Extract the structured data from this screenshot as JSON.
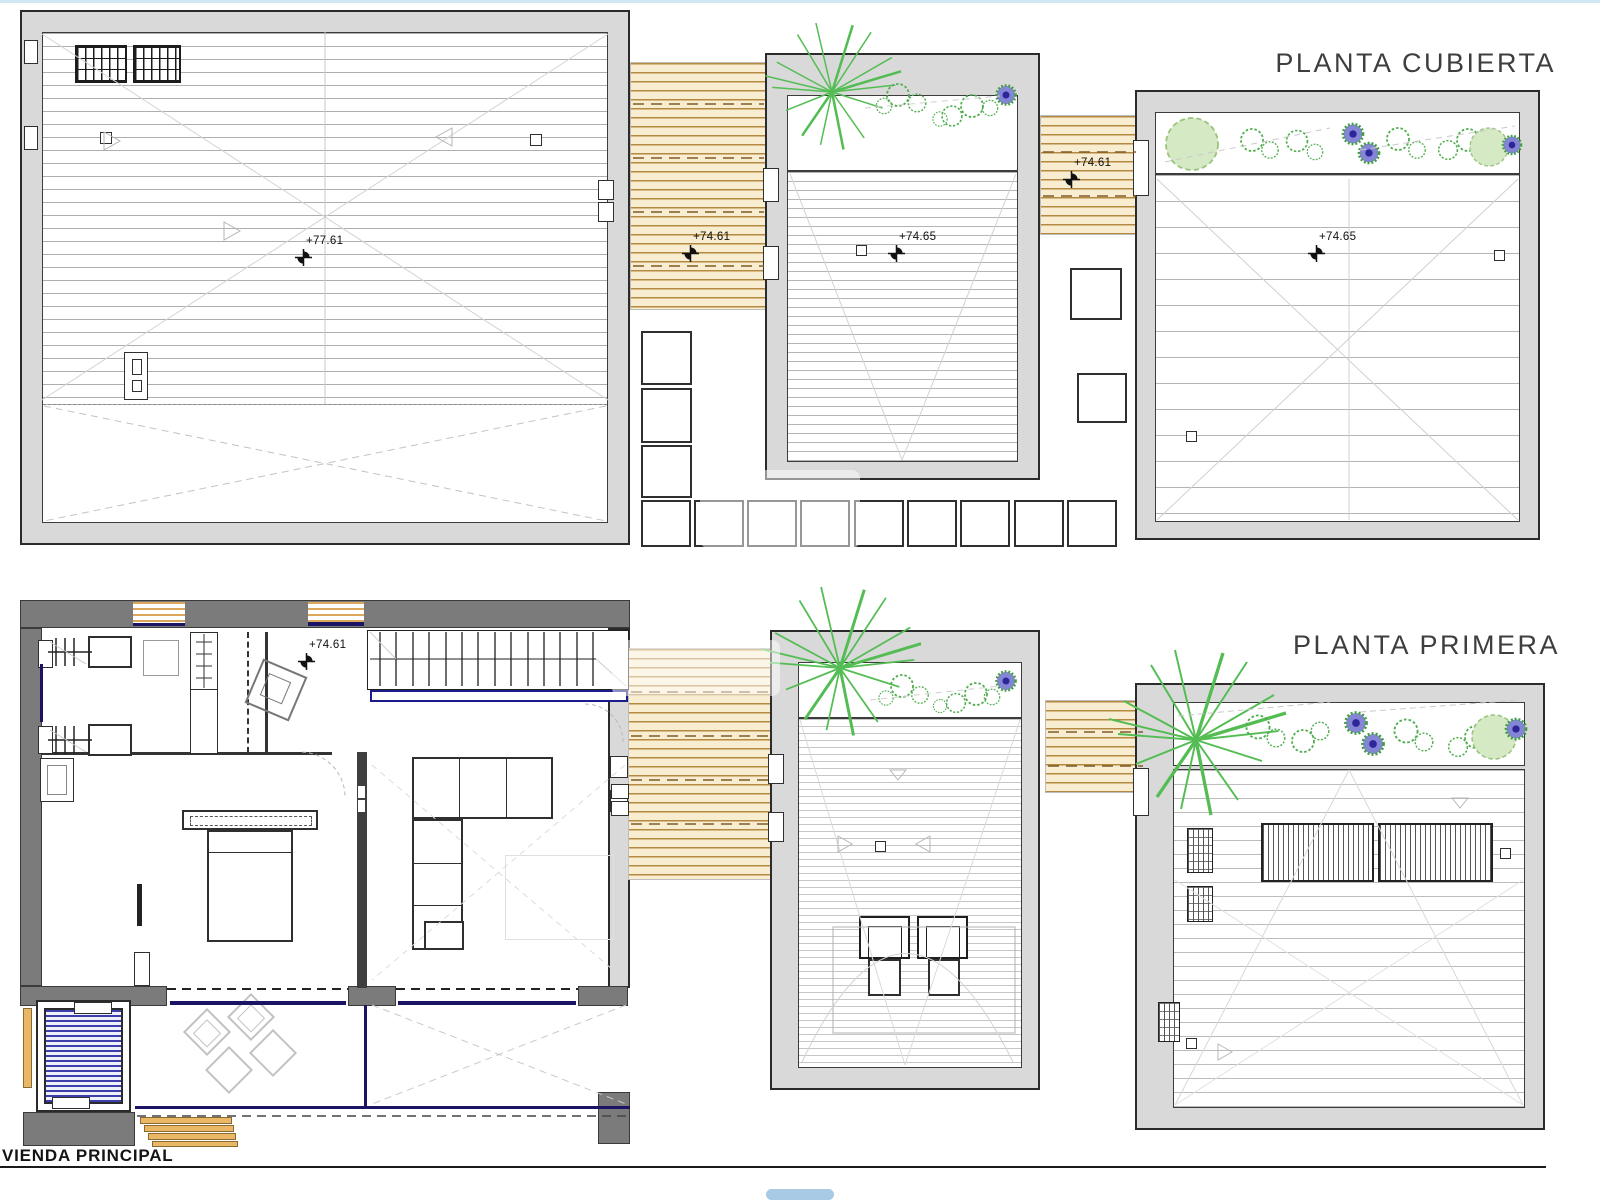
{
  "titles": {
    "roof_plan": "PLANTA CUBIERTA",
    "first_floor_plan": "PLANTA PRIMERA",
    "sheet_label": "VIENDA PRINCIPAL"
  },
  "levels": {
    "roof_main": "+77.61",
    "roof_deck_a": "+74.61",
    "roof_guest": "+74.65",
    "roof_deck_b": "+74.61",
    "roof_annex": "+74.65",
    "first_floor_main": "+74.61"
  },
  "colors": {
    "wall_light": "#d9d9d9",
    "wall_dark": "#7b7b7b",
    "deck_wood": "#f8edd0",
    "deck_line": "#b5893f",
    "pool_blue": "#3d3dae",
    "railing_blue": "#1b1464",
    "plant_green": "#53bd53",
    "flower_violet": "#5b54c0"
  }
}
